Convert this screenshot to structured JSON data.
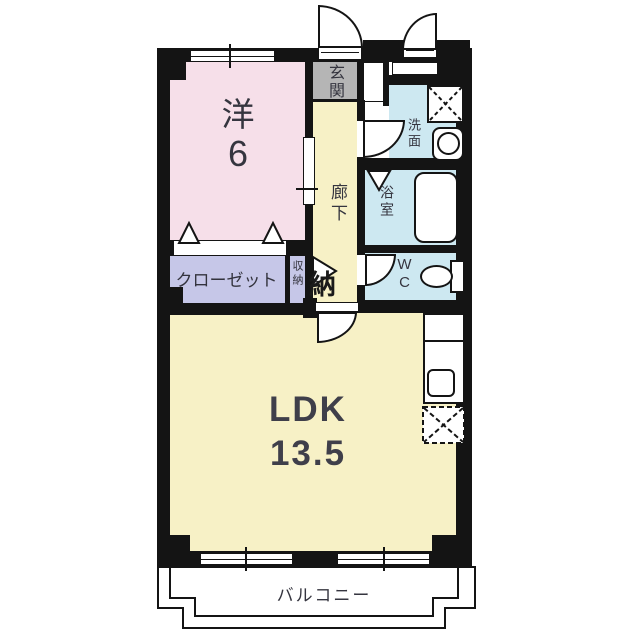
{
  "plan": {
    "rooms": {
      "western": {
        "name": "洋",
        "size": "6"
      },
      "ldk": {
        "name": "LDK",
        "size": "13.5"
      },
      "entrance": {
        "name": "玄関"
      },
      "hallway": {
        "name": "廊下"
      },
      "washroom": {
        "name": "洗面"
      },
      "bathroom": {
        "name": "浴室"
      },
      "toilet": {
        "name": "WC"
      },
      "closet": {
        "name": "クローゼット"
      },
      "storage": {
        "name": "収納",
        "big_char": "納"
      },
      "balcony": {
        "name": "バルコニー"
      }
    },
    "colors": {
      "wall": "#141414",
      "western_room": "#f6dfe9",
      "ldk": "#f7f1c6",
      "hallway": "#f7f1c6",
      "entrance": "#b5b5b5",
      "wet_area": "#cde8f1",
      "closet": "#c6c7e8",
      "fixture": "#ffffff"
    }
  }
}
